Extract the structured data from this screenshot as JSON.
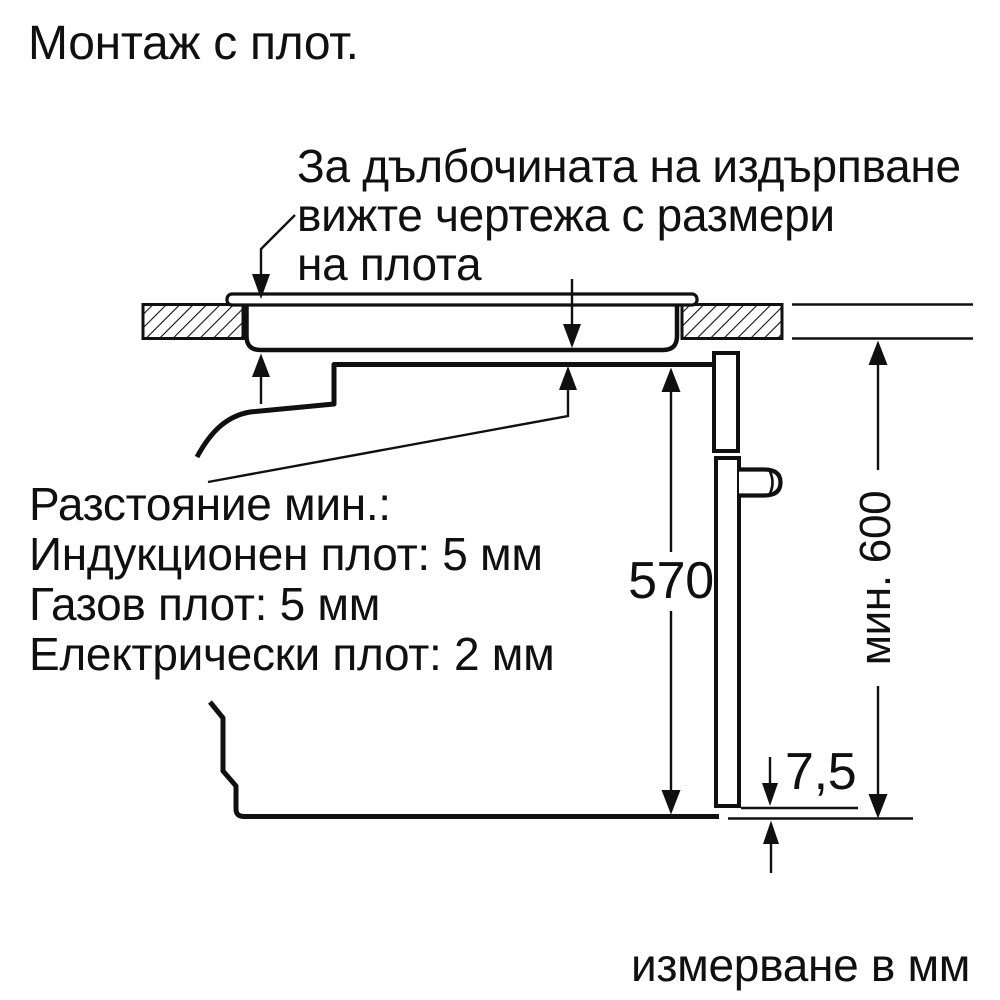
{
  "title": "Монтаж с плот.",
  "note": {
    "lines": [
      "За дълбочината на издърпване",
      "вижте чертежа с размери",
      "на плота"
    ]
  },
  "clearance": {
    "lines": [
      "Разстояние мин.:",
      "Индукционен плот: 5 мм",
      "Газов плот: 5 мм",
      "Електрически плот: 2 мм"
    ]
  },
  "dimensions": {
    "cavity_height": "570",
    "niche_min_height": "мин. 600",
    "bottom_gap": "7,5"
  },
  "footer": "измерване в мм",
  "colors": {
    "ink": "#101010",
    "background": "#ffffff"
  }
}
